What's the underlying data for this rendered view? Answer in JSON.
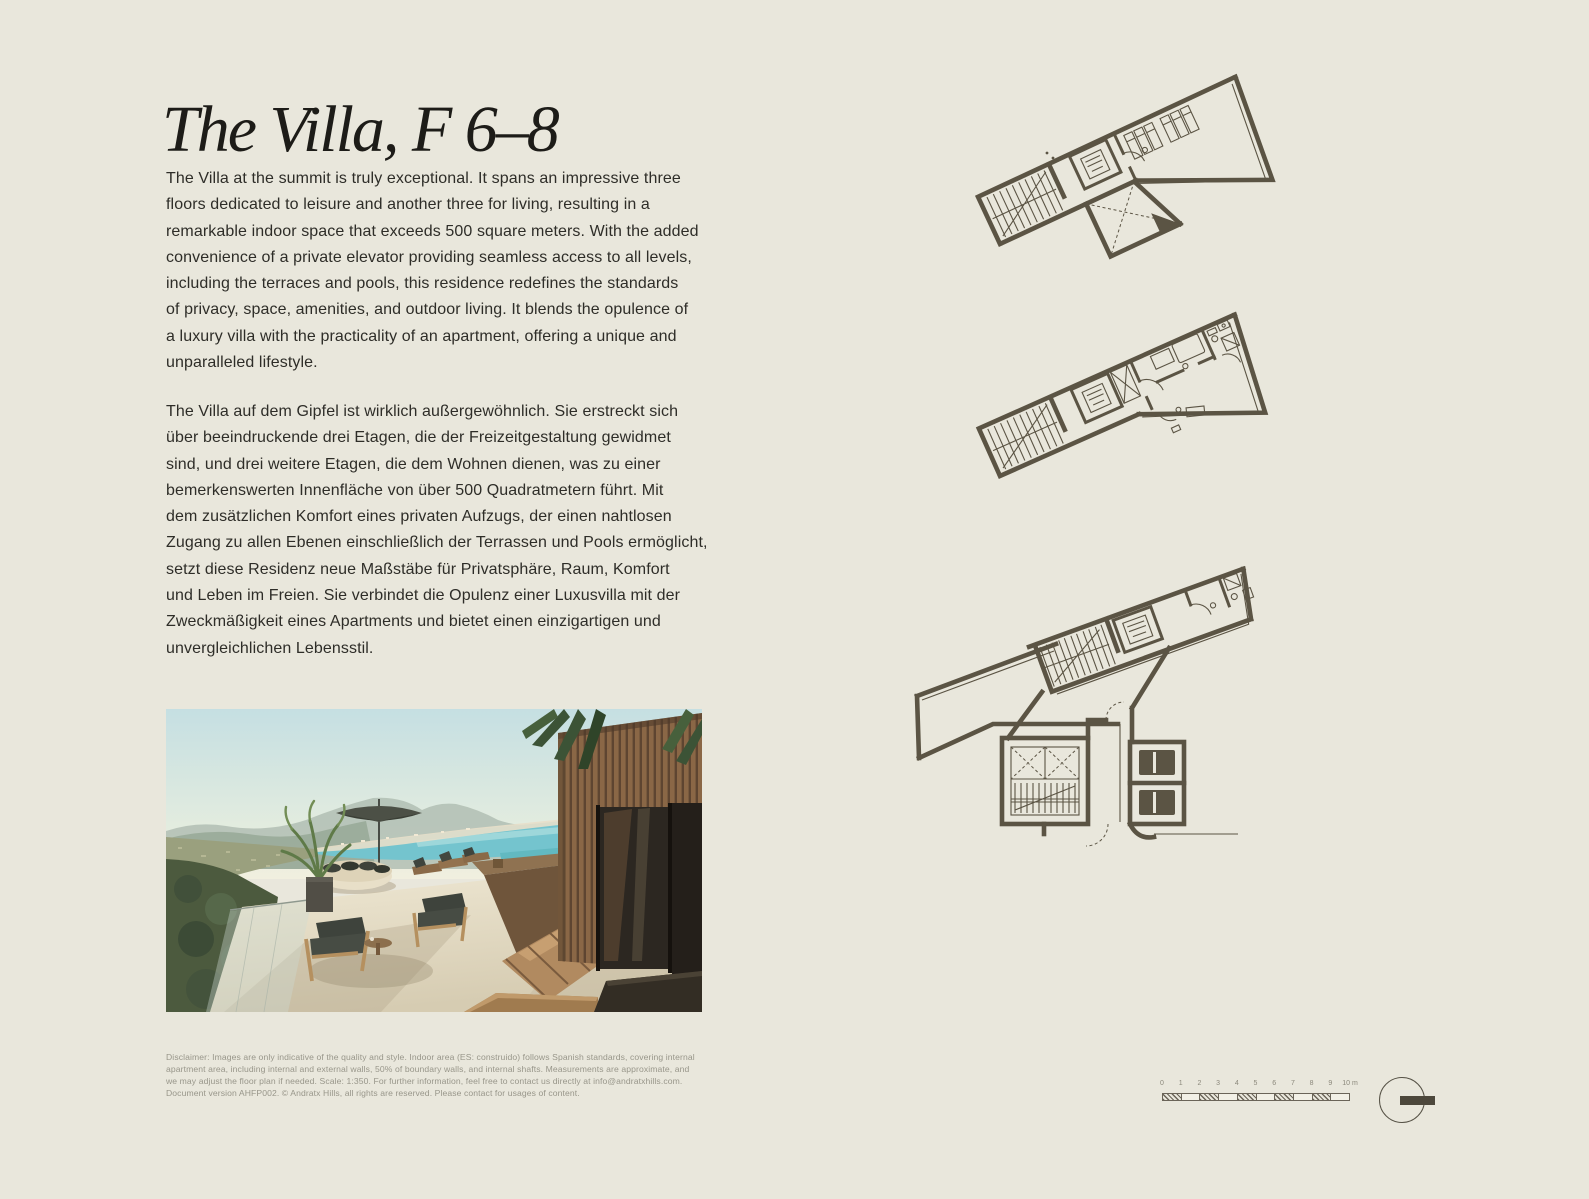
{
  "colors": {
    "background": "#e9e7dc",
    "heading_ink": "#1d1c18",
    "body_ink": "#2e2d28",
    "muted_ink": "#98968a",
    "plan_ink": "#5b5444"
  },
  "header": {
    "title": "The Villa, F 6–8"
  },
  "paragraphs": {
    "english": "The Villa at the summit is truly exceptional. It spans an impressive three\nfloors dedicated to leisure and another three for living, resulting in a\nremarkable indoor space that exceeds 500 square meters. With the added\nconvenience of a private elevator providing seamless access to all levels,\nincluding the terraces and pools, this residence redefines the standards\nof privacy, space, amenities, and outdoor living. It blends the opulence of\na luxury villa with the practicality of an apartment, offering a unique and\nunparalleled lifestyle.",
    "german": "The Villa auf dem Gipfel ist wirklich außergewöhnlich. Sie erstreckt sich\nüber beeindruckende drei Etagen, die der Freizeitgestaltung gewidmet\nsind, und drei weitere Etagen, die dem Wohnen dienen, was zu einer\nbemerkenswerten Innenfläche von über 500 Quadratmetern führt. Mit\ndem zusätzlichen Komfort eines privaten Aufzugs, der einen nahtlosen\nZugang zu allen Ebenen einschließlich der Terrassen und Pools ermöglicht,\nsetzt diese Residenz neue Maßstäbe für Privatsphäre, Raum, Komfort\nund Leben im Freien. Sie verbindet die Opulenz einer Luxusvilla mit der\nZweckmäßigkeit eines Apartments und bietet einen einzigartigen und\nunvergleichlichen Lebensstil."
  },
  "disclaimer": "Disclaimer: Images are only indicative of the quality and style. Indoor area (ES: construido) follows Spanish standards, covering internal\napartment area, including internal and external walls, 50% of boundary walls, and internal shafts. Measurements are approximate, and\nwe may adjust the floor plan if needed. Scale: 1:350. For further information, feel free to contact us directly at info@andratxhills.com.\nDocument version AHFP002. © Andratx Hills, all rights are reserved. Please contact for usages of content.",
  "scalebar": {
    "labels": [
      "0",
      "1",
      "2",
      "3",
      "4",
      "5",
      "6",
      "7",
      "8",
      "9",
      "10 m"
    ]
  }
}
